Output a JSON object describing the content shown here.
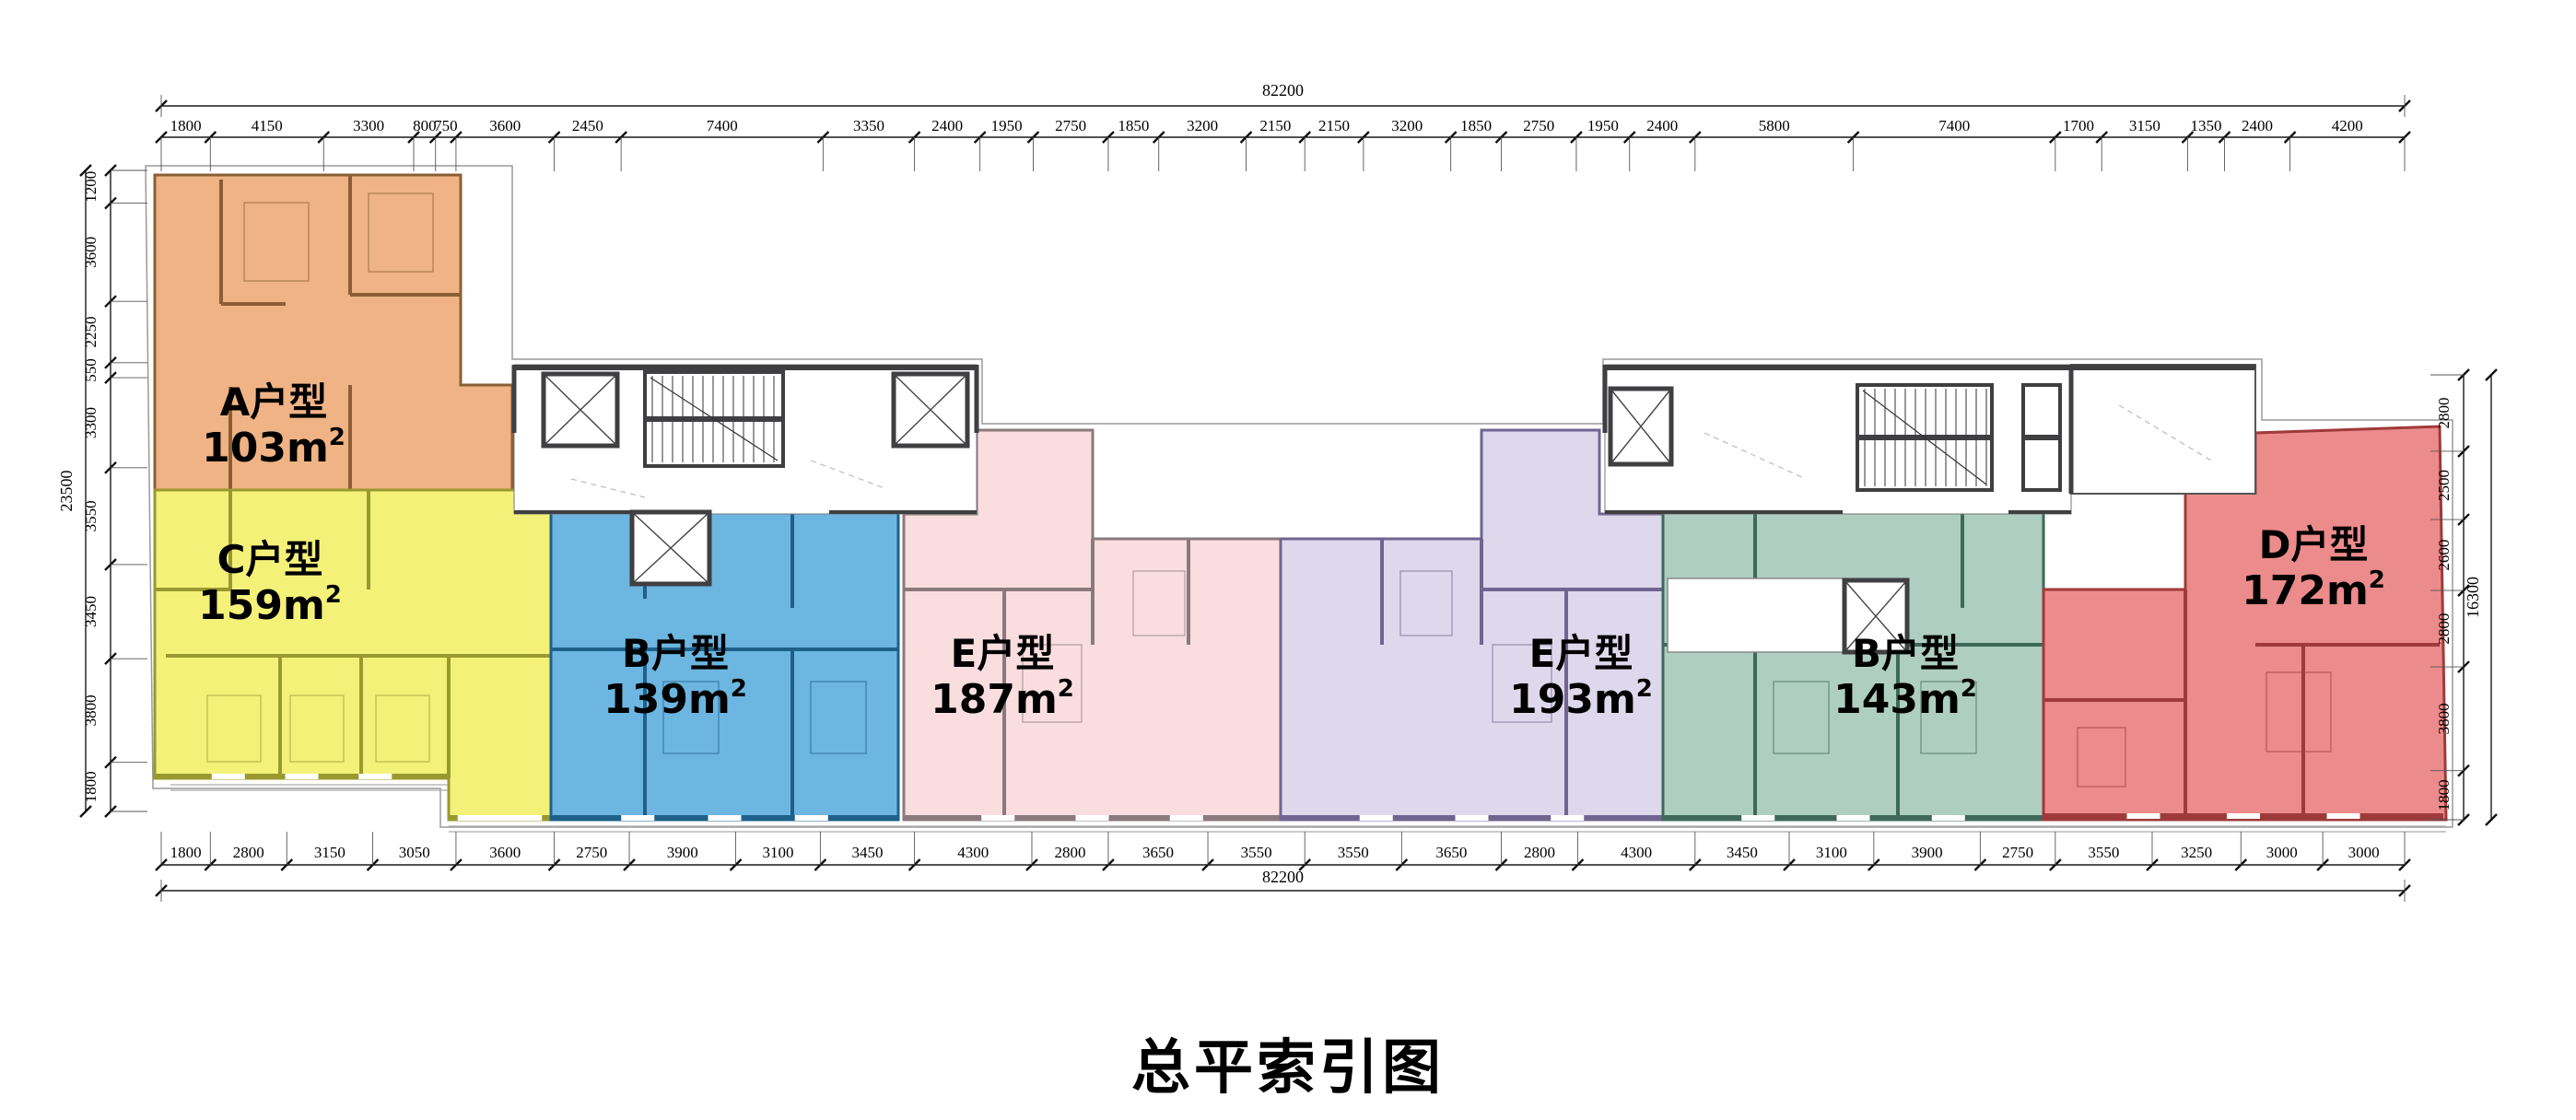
{
  "title": "总平索引图",
  "dims": {
    "top": {
      "total": "82200",
      "segments": [
        1800,
        4150,
        3300,
        800,
        750,
        3600,
        2450,
        7400,
        3350,
        2400,
        1950,
        2750,
        1850,
        3200,
        2150,
        2150,
        3200,
        1850,
        2750,
        1950,
        2400,
        5800,
        7400,
        1700,
        3150,
        1350,
        2400,
        4200
      ]
    },
    "bottom": {
      "total": "82200",
      "segments": [
        1800,
        2800,
        3150,
        3050,
        3600,
        2750,
        3900,
        3100,
        3450,
        4300,
        2800,
        3650,
        3550,
        3550,
        3650,
        2800,
        4300,
        3450,
        3100,
        3900,
        2750,
        3550,
        3250,
        3000,
        3000
      ]
    },
    "left": {
      "total": "23500",
      "segments": [
        1200,
        3600,
        2250,
        550,
        3300,
        3550,
        3450,
        3800,
        1800
      ]
    },
    "right": {
      "total": "16300",
      "segments": [
        2800,
        2500,
        2600,
        2800,
        3800,
        1800
      ]
    }
  },
  "units": [
    {
      "id": "A",
      "label": "A户型",
      "area": "103m²",
      "fill": "#EFAC7B",
      "wall": "#8B5E34"
    },
    {
      "id": "C",
      "label": "C户型",
      "area": "159m²",
      "fill": "#F3F06E",
      "wall": "#99992F"
    },
    {
      "id": "B1",
      "label": "B户型",
      "area": "139m²",
      "fill": "#5FB0DE",
      "wall": "#1E6089"
    },
    {
      "id": "E1",
      "label": "E户型",
      "area": "187m²",
      "fill": "#F8DADC",
      "wall": "#8A7A7E"
    },
    {
      "id": "E2",
      "label": "E户型",
      "area": "193m²",
      "fill": "#DBD5EA",
      "wall": "#6F6590"
    },
    {
      "id": "B2",
      "label": "B户型",
      "area": "143m²",
      "fill": "#A7CABC",
      "wall": "#3E685A"
    },
    {
      "id": "D",
      "label": "D户型",
      "area": "172m²",
      "fill": "#EA8181",
      "wall": "#9E3A3A"
    }
  ],
  "colors": {
    "core_wall": "#3F3F42",
    "dim_line": "#1A1A1A",
    "light_line": "#9A9A9A",
    "text": "#000000",
    "background": "#FFFFFF"
  }
}
